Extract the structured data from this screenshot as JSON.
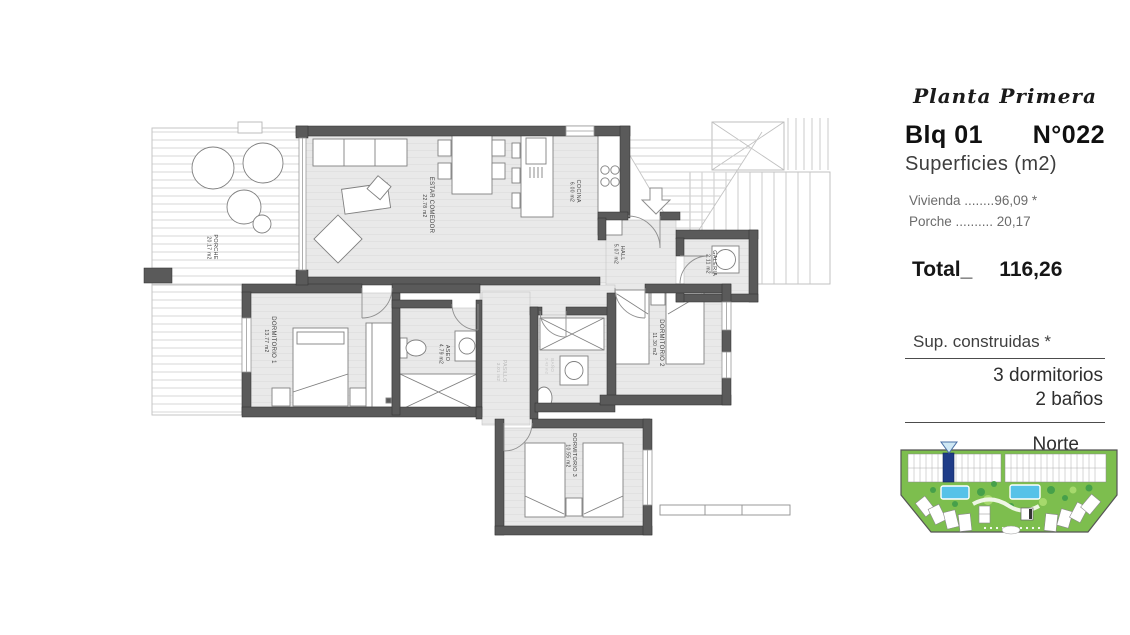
{
  "info_panel": {
    "title": "Planta Primera",
    "block_label": "Blq 01",
    "unit_label": "N°022",
    "surfaces_heading": "Superficies (m2)",
    "surface_rows": [
      {
        "label": "Vivienda",
        "leader": " ........",
        "value": "96,09 *"
      },
      {
        "label": "Porche",
        "leader": " .......... ",
        "value": "20,17"
      }
    ],
    "total_label": "Total_",
    "total_value": "116,26",
    "built_surface_note": "Sup. construidas *",
    "program": {
      "bedrooms": "3 dormitorios",
      "bathrooms": "2 baños"
    },
    "north_label": "Norte"
  },
  "floorplan": {
    "rooms": [
      {
        "name": "PORCHE",
        "area": "20.17 m2"
      },
      {
        "name": "ESTAR COMEDOR",
        "area": "22.78 m2"
      },
      {
        "name": "COCINA",
        "area": "6.00 m2"
      },
      {
        "name": "HALL",
        "area": "5.07 m2"
      },
      {
        "name": "GALERIA",
        "area": "2.11 m2"
      },
      {
        "name": "DORMITORIO 1",
        "area": "13.77 m2"
      },
      {
        "name": "ASEO",
        "area": "4.79 m2"
      },
      {
        "name": "PASILLO",
        "area": "3.01 m2"
      },
      {
        "name": "BAÑO",
        "area": "3.43 m2"
      },
      {
        "name": "DORMITORIO 2",
        "area": "11.30 m2"
      },
      {
        "name": "DORMITORIO 3",
        "area": "10.55 m2"
      }
    ]
  },
  "colors": {
    "wall": "#5a5a5a",
    "floor": "#e9e9e9",
    "outline": "#c6c6c6",
    "marker_blue": "#1f3c88",
    "pool_blue": "#56c2e8",
    "site_green": "#7dbe4e",
    "text_dark": "#3a3a3a"
  }
}
